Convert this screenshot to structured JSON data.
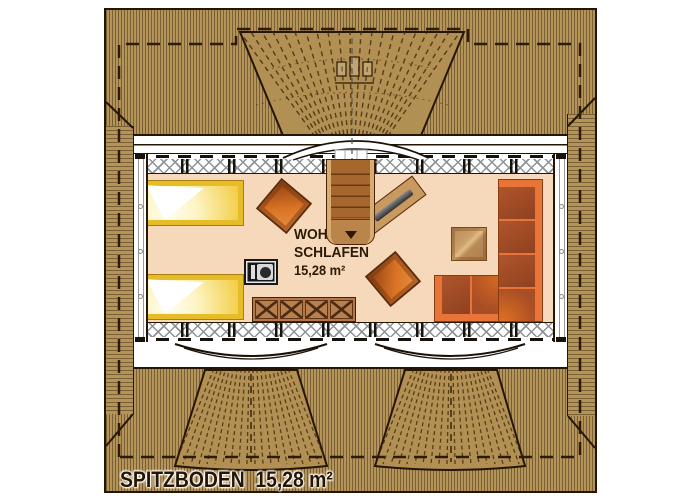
{
  "floor_plan": {
    "floor_label": {
      "name": "SPITZBODEN",
      "area": "15,28 m²"
    },
    "room_label": {
      "line1": "WOHNEN /",
      "line2": "SCHLAFEN",
      "area": "15,28 m²"
    },
    "furniture": [
      "single-bed",
      "single-bed",
      "armchair",
      "armchair",
      "tv-sideboard",
      "wood-stove",
      "x-front-dresser",
      "corner-sofa",
      "coffee-table",
      "staircase"
    ],
    "features": [
      "eyebrow-dormer-top",
      "roof-window-bottom-left",
      "roof-window-bottom-right",
      "knee-wall-insulation",
      "band-windows",
      "roof-overhang-dashed-outline"
    ],
    "colors": {
      "roof_wood": "#b5945a",
      "roof_hatch": "#3e2c0e",
      "floor": "#f5d9ba",
      "bed_yellow": "#e6bc28",
      "sofa_orange": "#e87438",
      "cushion_brown": "#a84e26",
      "outline_dark": "#241505",
      "text": "#2b1a08"
    }
  }
}
